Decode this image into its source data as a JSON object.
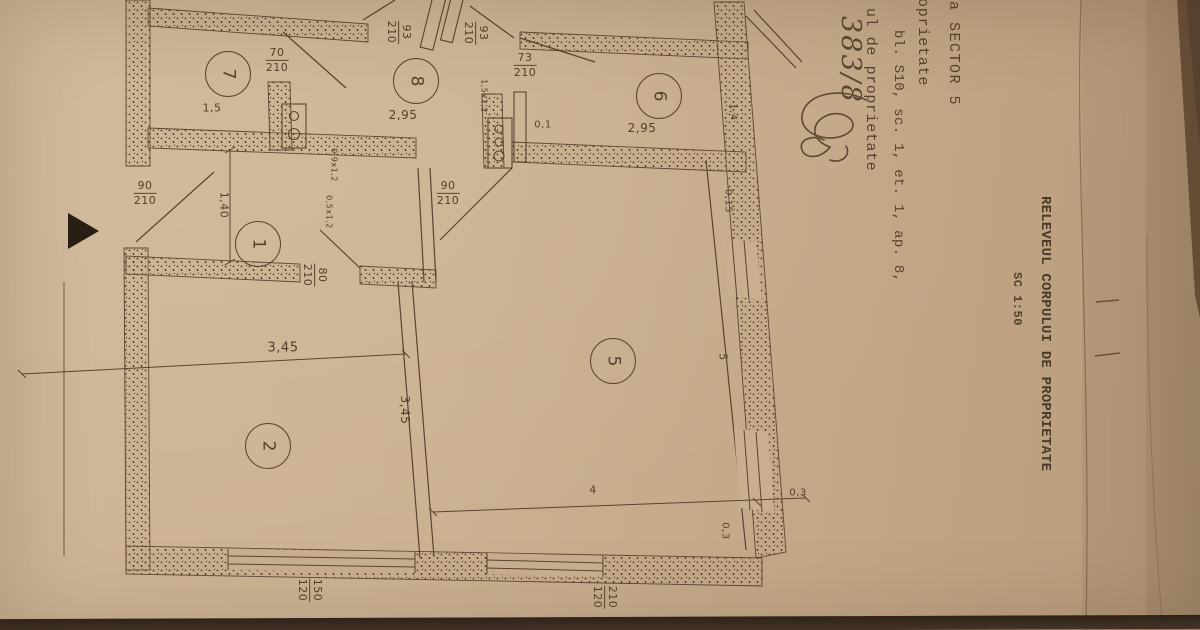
{
  "document": {
    "title": "RELEVEUL CORPULUI DE PROPRIETATE",
    "scale": "SC 1:50",
    "header_lines": [
      "ala SECTOR 5",
      "oprietate",
      "bl. S10, sc. 1, et. 1, ap. 8,",
      "ul de proprietate"
    ],
    "handwritten_note": "383/8"
  },
  "plan": {
    "rooms": [
      {
        "number": "7",
        "x": 227,
        "y": 73
      },
      {
        "number": "8",
        "x": 415,
        "y": 80
      },
      {
        "number": "6",
        "x": 658,
        "y": 95
      },
      {
        "number": "1",
        "x": 257,
        "y": 243
      },
      {
        "number": "2",
        "x": 267,
        "y": 445
      },
      {
        "number": "5",
        "x": 612,
        "y": 360
      }
    ],
    "door_labels": [
      {
        "num": "70",
        "den": "210",
        "x": 277,
        "y": 60,
        "rot": 0
      },
      {
        "num": "93",
        "den": "210",
        "x": 399,
        "y": 32,
        "rot": 90
      },
      {
        "num": "93",
        "den": "210",
        "x": 476,
        "y": 33,
        "rot": 90
      },
      {
        "num": "73",
        "den": "210",
        "x": 525,
        "y": 65,
        "rot": 0
      },
      {
        "num": "90",
        "den": "210",
        "x": 145,
        "y": 193,
        "rot": 0
      },
      {
        "num": "90",
        "den": "210",
        "x": 448,
        "y": 193,
        "rot": 0
      },
      {
        "num": "80",
        "den": "210",
        "x": 315,
        "y": 275,
        "rot": 90
      },
      {
        "num": "150",
        "den": "120",
        "x": 310,
        "y": 590,
        "rot": 90
      },
      {
        "num": "210",
        "den": "120",
        "x": 605,
        "y": 597,
        "rot": 90
      }
    ],
    "dimensions": [
      {
        "text": "1,5",
        "x": 212,
        "y": 108,
        "rot": 0,
        "size": 11
      },
      {
        "text": "2,95",
        "x": 403,
        "y": 115,
        "rot": 0,
        "size": 12
      },
      {
        "text": "0,1",
        "x": 543,
        "y": 125,
        "rot": 0,
        "size": 10
      },
      {
        "text": "2,95",
        "x": 642,
        "y": 128,
        "rot": 0,
        "size": 12
      },
      {
        "text": "1,4",
        "x": 733,
        "y": 112,
        "rot": 90,
        "size": 10
      },
      {
        "text": "0,15",
        "x": 728,
        "y": 201,
        "rot": 90,
        "size": 10
      },
      {
        "text": "1,40",
        "x": 224,
        "y": 205,
        "rot": 90,
        "size": 11
      },
      {
        "text": "3,45",
        "x": 283,
        "y": 348,
        "rot": 0,
        "size": 13
      },
      {
        "text": "3,45",
        "x": 405,
        "y": 410,
        "rot": 90,
        "size": 12
      },
      {
        "text": "5",
        "x": 723,
        "y": 357,
        "rot": 90,
        "size": 11
      },
      {
        "text": "4",
        "x": 593,
        "y": 490,
        "rot": 0,
        "size": 11
      },
      {
        "text": "0,3",
        "x": 798,
        "y": 493,
        "rot": 0,
        "size": 10
      },
      {
        "text": "0,3",
        "x": 725,
        "y": 531,
        "rot": 90,
        "size": 10
      },
      {
        "text": "1,5x1,2",
        "x": 484,
        "y": 96,
        "rot": 90,
        "size": 8
      },
      {
        "text": "0,9x1,2",
        "x": 334,
        "y": 165,
        "rot": 90,
        "size": 8
      },
      {
        "text": "0,5x1,2",
        "x": 329,
        "y": 212,
        "rot": 90,
        "size": 8
      }
    ]
  },
  "colors": {
    "paper": "#c9af90",
    "paper_shadow": "#b89c7c",
    "ink": "#5a4430",
    "wall_speckle": "#4d3a28",
    "table": "#3a2d22"
  }
}
